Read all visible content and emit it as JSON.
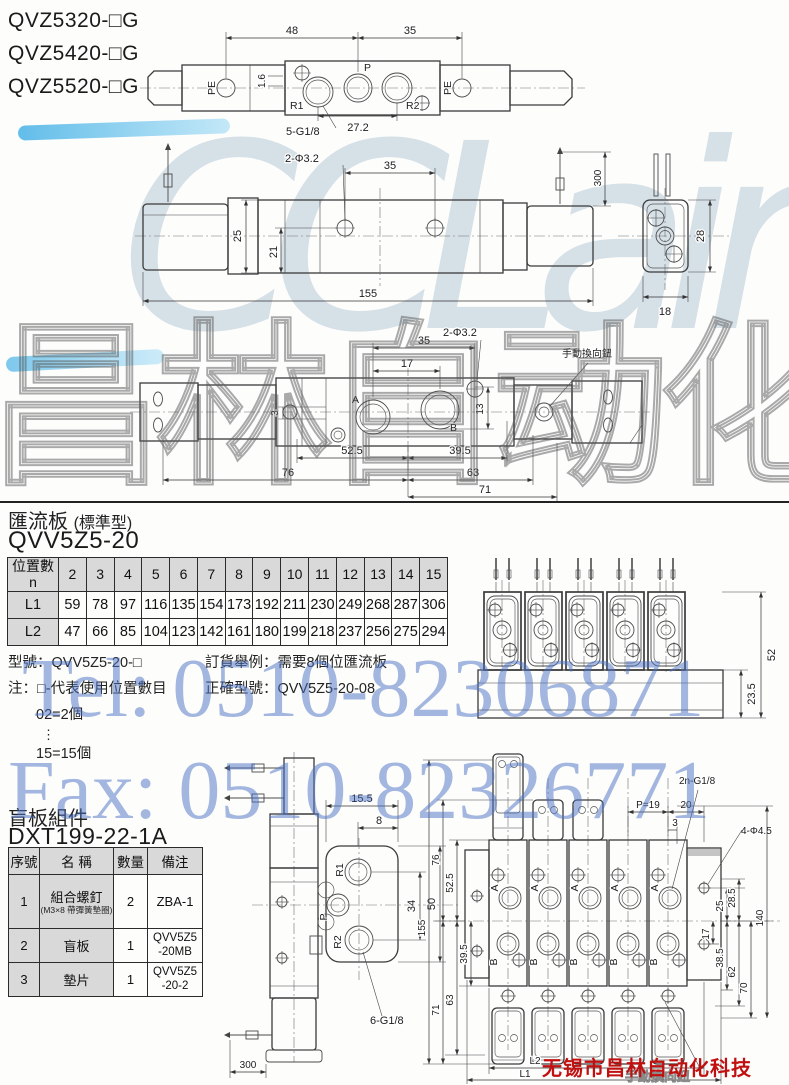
{
  "models": {
    "m1": "QVZ5320-□G",
    "m2": "QVZ5420-□G",
    "m3": "QVZ5520-□G"
  },
  "watermark": {
    "logo": "CCLair",
    "brand": "昌林自动化",
    "tel": "Tel: 0510-82306871",
    "fax": "Fax: 0510-82326771"
  },
  "vendor": {
    "name": "无锡市昌林自动化科技"
  },
  "sec1": {
    "title": "匯流板",
    "subtitle": "(標準型)",
    "model": "QVV5Z5-20"
  },
  "table1": {
    "h1": "位置數",
    "h2": "n",
    "positions": [
      "2",
      "3",
      "4",
      "5",
      "6",
      "7",
      "8",
      "9",
      "10",
      "11",
      "12",
      "13",
      "14",
      "15"
    ],
    "l1_label": "L1",
    "l1": [
      "59",
      "78",
      "97",
      "116",
      "135",
      "154",
      "173",
      "192",
      "211",
      "230",
      "249",
      "268",
      "287",
      "306"
    ],
    "l2_label": "L2",
    "l2": [
      "47",
      "66",
      "85",
      "104",
      "123",
      "142",
      "161",
      "180",
      "199",
      "218",
      "237",
      "256",
      "275",
      "294"
    ]
  },
  "notes": {
    "line1": "型號：QVV5Z5-20-□",
    "line2": "注：□-代表使用位置數目",
    "ex1": "02=2個",
    "dots": "⋮",
    "ex2": "15=15個",
    "r1": "訂貨舉例：需要8個位匯流板",
    "r2": "正確型號：QVV5Z5-20-08"
  },
  "sec2": {
    "title": "盲板組件",
    "model": "DXT199-22-1A"
  },
  "table2": {
    "h1": "序號",
    "h2": "名 稱",
    "h3": "數量",
    "h4": "備注",
    "r1": {
      "no": "1",
      "name": "組合螺釘",
      "sub": "(M3×8 帶彈簧墊圈)",
      "qty": "2",
      "rk": "ZBA-1"
    },
    "r2": {
      "no": "2",
      "name": "盲板",
      "qty": "1",
      "rk": "QVV5Z5",
      "rk2": "-20MB"
    },
    "r3": {
      "no": "3",
      "name": "墊片",
      "qty": "1",
      "rk": "QVV5Z5",
      "rk2": "-20-2"
    }
  },
  "d1": {
    "d48": "48",
    "d35": "35",
    "d272": "27.2",
    "d16": "1.6",
    "pe": "PE",
    "p": "P",
    "r1": "R1",
    "r2": "R2",
    "thread": "5-G1/8"
  },
  "d2": {
    "holes": "2-Φ3.2",
    "d35": "35",
    "d25": "25",
    "d21": "21",
    "d155": "155",
    "d300": "300",
    "d28": "28",
    "d18": "18"
  },
  "d3": {
    "d35": "35",
    "d17": "17",
    "holes": "2-Φ3.2",
    "manual": "手動換向鈕",
    "a": "A",
    "b": "B",
    "d3": "3",
    "d13": "13",
    "d525": "52.5",
    "d395": "39.5",
    "d76": "76",
    "d63": "63",
    "d71": "71"
  },
  "d4": {
    "d52": "52",
    "d235": "23.5"
  },
  "d5": {
    "d155": "15.5",
    "d8": "8",
    "r1": "R1",
    "p": "P",
    "r2": "R2",
    "d34": "34",
    "d50": "50",
    "thread": "6-G1/8",
    "d300": "300"
  },
  "d6": {
    "thread": "2n-G1/8",
    "p19": "P=19",
    "d20": "20",
    "d3": "3",
    "holes": "4-Φ4.5",
    "d76": "76",
    "d525": "52.5",
    "d395": "39.5",
    "d155": "155",
    "d71": "71",
    "d63": "63",
    "d25": "25",
    "d285": "28.5",
    "d17": "17",
    "d385": "38.5",
    "d62": "62",
    "d70": "70",
    "d140": "140",
    "l1": "L1",
    "l2": "L2",
    "a": "A",
    "b": "B",
    "manual": "手動換向鈕"
  }
}
